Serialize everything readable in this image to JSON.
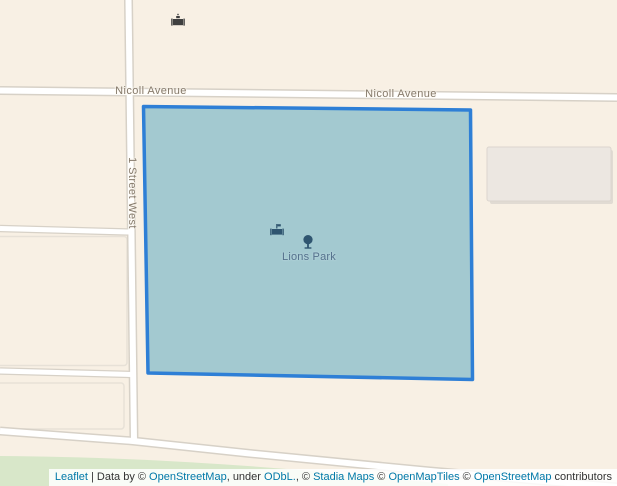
{
  "map": {
    "streets": {
      "nicoll_avenue_left": "Nicoll Avenue",
      "nicoll_avenue_right": "Nicoll Avenue",
      "first_street_west": "1 Street West"
    },
    "park": {
      "name": "Lions Park"
    },
    "icons": {
      "top_poi": "picnic-site-icon",
      "park_picnic": "picnic-site-icon",
      "park_tree": "tree-icon"
    },
    "colors": {
      "background": "#f8f0e4",
      "road_fill": "#ffffff",
      "road_casing": "#d7d1c7",
      "park_fill": "#a3c9d0",
      "park_stroke": "#2e7fd6",
      "greenspace": "#d8e7c9",
      "building": "#ece7e1",
      "street_label": "#857a6b",
      "park_label": "#54718c",
      "park_icon": "#2f5570",
      "poi_icon": "#3f3f3f",
      "link": "#0078A8"
    }
  },
  "attribution": {
    "leaflet_link": "Leaflet",
    "sep1": " | Data by © ",
    "osm_link1": "OpenStreetMap",
    "sep2": ", under ",
    "odbl_link": "ODbL.",
    "sep3": ", © ",
    "stadia_link": "Stadia Maps",
    "sep4": " © ",
    "openmaptiles_link": "OpenMapTiles",
    "sep5": " © ",
    "osm_link2": "OpenStreetMap",
    "sep6": " contributors"
  }
}
